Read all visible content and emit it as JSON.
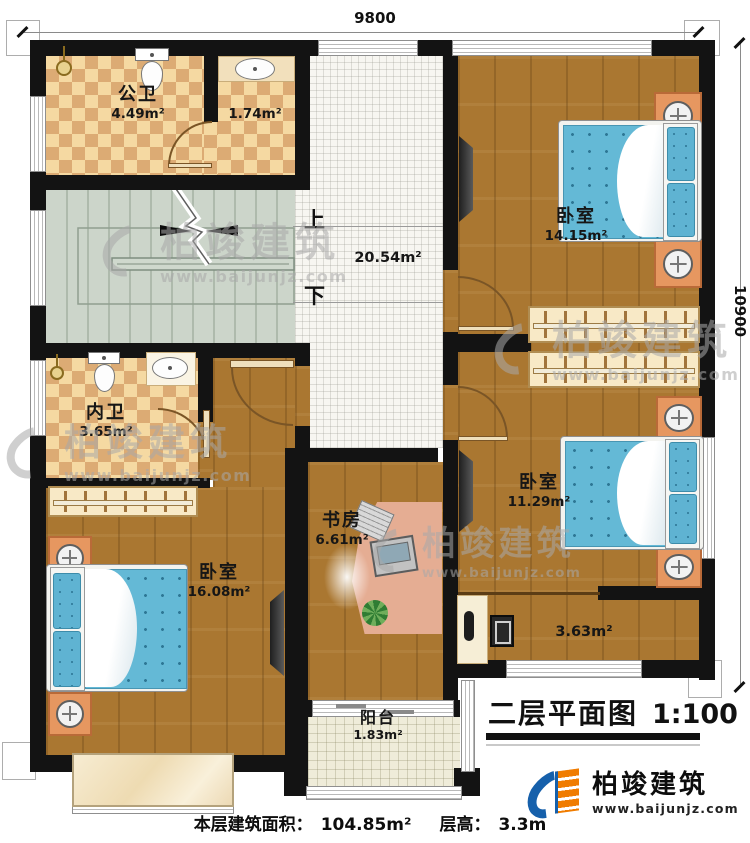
{
  "plan": {
    "rooms": {
      "public_bath": {
        "label": "公卫",
        "area": "4.49m²"
      },
      "wash_room": {
        "area": "1.74m²"
      },
      "hall": {
        "area": "20.54m²"
      },
      "bedroom_top": {
        "label": "卧室",
        "area": "14.15m²"
      },
      "inner_bath": {
        "label": "内卫",
        "area": "3.65m²"
      },
      "bedroom_left": {
        "label": "卧室",
        "area": "16.08m²"
      },
      "study": {
        "label": "书房",
        "area": "6.61m²"
      },
      "bedroom_right": {
        "label": "卧室",
        "area": "11.29m²"
      },
      "dressing_corridor": {
        "area": "3.63m²"
      },
      "balcony": {
        "label": "阳台",
        "area": "1.83m²"
      }
    },
    "stairs": {
      "up_label": "上",
      "down_label": "下"
    },
    "dimensions": {
      "top": "9800",
      "right": "10900"
    }
  },
  "title_block": {
    "title": "二层平面图",
    "scale": "1:100"
  },
  "footer": {
    "floor_area_label": "本层建筑面积：",
    "floor_area_value": "104.85m²",
    "floor_height_label": "层高：",
    "floor_height_value": "3.3m"
  },
  "brand": {
    "name": "柏竣建筑",
    "website": "www.baijunjz.com"
  },
  "watermark": {
    "name": "柏竣建筑",
    "website": "www.baijunjz.com"
  },
  "colors": {
    "wall": "#131313",
    "wood_floor": "#aa7731",
    "bath_tile_light": "#f5d9a2",
    "bath_tile_dark": "#dcab74",
    "stair_floor": "#ccd5ca",
    "bed_blue": "#64b9d6",
    "logo_blue": "#1660ab",
    "logo_orange": "#f07c00"
  }
}
